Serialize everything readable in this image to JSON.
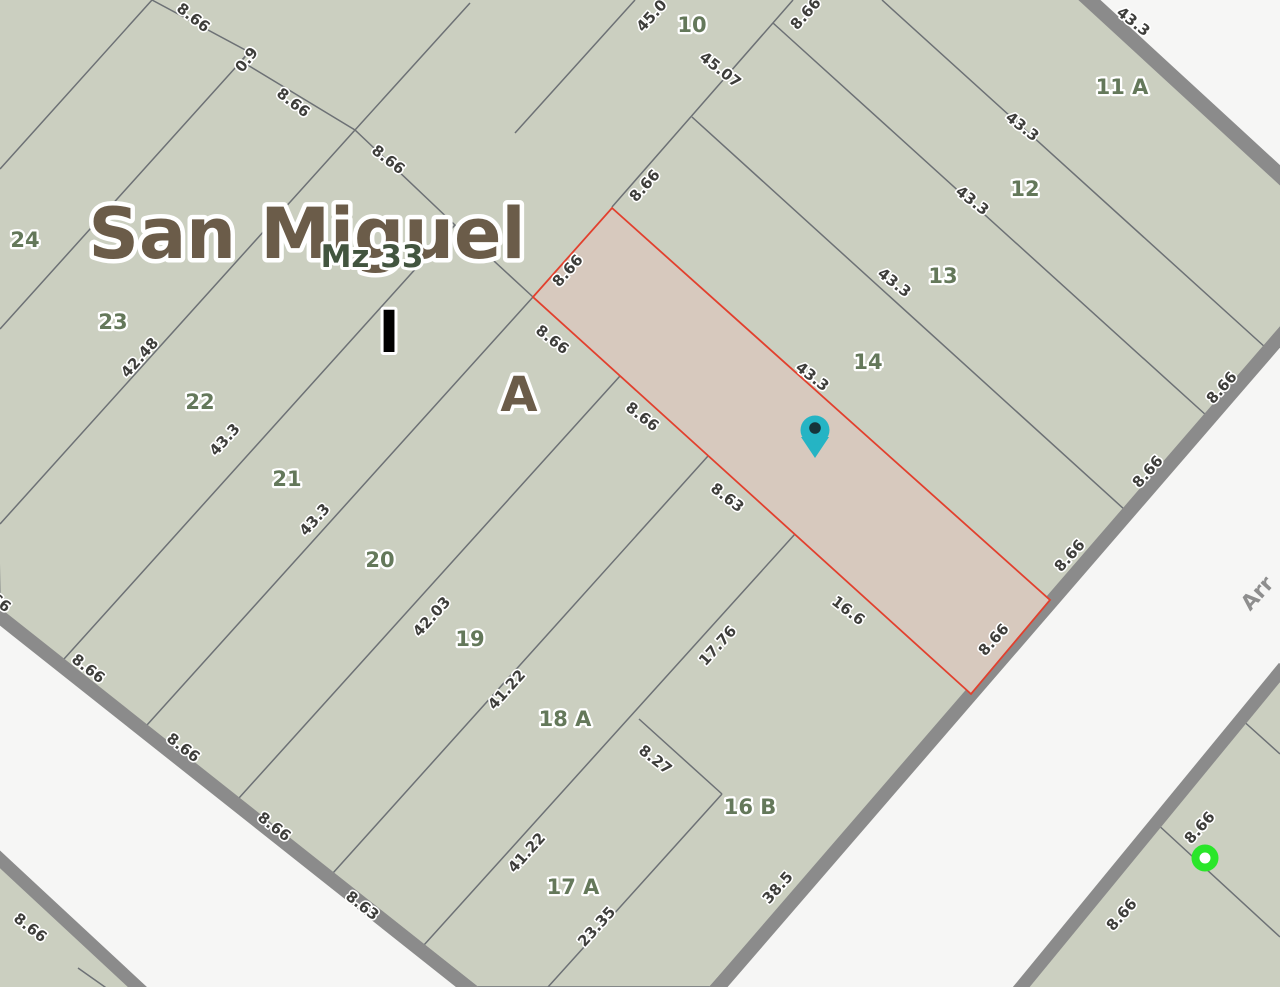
{
  "map": {
    "title": "San Miguel",
    "block_label": "Mz 33",
    "sector_labels": {
      "i": "I",
      "a": "A"
    },
    "street_name": "Arr",
    "colors": {
      "background": "#f6f6f5",
      "parcel_fill": "#cbcfc0",
      "highlight_fill": "#d7c9be",
      "highlight_stroke": "#e2402e",
      "road_casing": "#8b8b8b",
      "lot_line": "#6d7175",
      "parcel_number": "#64785a",
      "dimension_text": "#3d3d3a",
      "title_text": "#6b5c49",
      "block_label_text": "#42553f",
      "pin_fill": "#25b4c4",
      "pin_hole": "#16343a",
      "dot_fill": "#2ae62a"
    },
    "parcel_number_labels": [
      {
        "t": "10",
        "x": 692,
        "y": 26
      },
      {
        "t": "11 A",
        "x": 1122,
        "y": 88
      },
      {
        "t": "12",
        "x": 1025,
        "y": 190
      },
      {
        "t": "13",
        "x": 943,
        "y": 277
      },
      {
        "t": "14",
        "x": 868,
        "y": 363
      },
      {
        "t": "16 B",
        "x": 750,
        "y": 808
      },
      {
        "t": "17 A",
        "x": 573,
        "y": 888
      },
      {
        "t": "18 A",
        "x": 565,
        "y": 720
      },
      {
        "t": "19",
        "x": 470,
        "y": 640
      },
      {
        "t": "20",
        "x": 380,
        "y": 561
      },
      {
        "t": "21",
        "x": 287,
        "y": 480
      },
      {
        "t": "22",
        "x": 200,
        "y": 403
      },
      {
        "t": "23",
        "x": 113,
        "y": 323
      },
      {
        "t": "24",
        "x": 25,
        "y": 241
      }
    ],
    "dimension_labels": [
      {
        "t": "45.0",
        "x": 652,
        "y": 16,
        "r": -48
      },
      {
        "t": "0.9",
        "x": 247,
        "y": 60,
        "r": -52
      },
      {
        "t": "8.66",
        "x": 568,
        "y": 271,
        "r": -48
      },
      {
        "t": "8.66",
        "x": 645,
        "y": 186,
        "r": -48
      },
      {
        "t": "8.66",
        "x": 806,
        "y": 14,
        "r": -48
      },
      {
        "t": "42.48",
        "x": 140,
        "y": 358,
        "r": -48
      },
      {
        "t": "43.3",
        "x": 225,
        "y": 440,
        "r": -48
      },
      {
        "t": "43.3",
        "x": 315,
        "y": 520,
        "r": -48
      },
      {
        "t": "42.03",
        "x": 432,
        "y": 617,
        "r": -48
      },
      {
        "t": "41.22",
        "x": 507,
        "y": 690,
        "r": -48
      },
      {
        "t": "17.76",
        "x": 718,
        "y": 646,
        "r": -48
      },
      {
        "t": "41.22",
        "x": 527,
        "y": 853,
        "r": -48
      },
      {
        "t": "23.35",
        "x": 597,
        "y": 927,
        "r": -48
      },
      {
        "t": "38.5",
        "x": 778,
        "y": 888,
        "r": -48
      },
      {
        "t": "8.66",
        "x": 1222,
        "y": 388,
        "r": -48
      },
      {
        "t": "8.66",
        "x": 1148,
        "y": 472,
        "r": -48
      },
      {
        "t": "8.66",
        "x": 1070,
        "y": 556,
        "r": -48
      },
      {
        "t": "8.66",
        "x": 994,
        "y": 640,
        "r": -48
      },
      {
        "t": "8.66",
        "x": 1200,
        "y": 828,
        "r": -48
      },
      {
        "t": "8.66",
        "x": 1122,
        "y": 915,
        "r": -48
      },
      {
        "t": "8.66",
        "x": 193,
        "y": 18,
        "r": 38
      },
      {
        "t": "8.66",
        "x": 293,
        "y": 103,
        "r": 38
      },
      {
        "t": "8.66",
        "x": 388,
        "y": 160,
        "r": 38
      },
      {
        "t": "8.66",
        "x": 552,
        "y": 340,
        "r": 38
      },
      {
        "t": "8.66",
        "x": 642,
        "y": 417,
        "r": 38
      },
      {
        "t": "8.63",
        "x": 727,
        "y": 498,
        "r": 38
      },
      {
        "t": "16.6",
        "x": 848,
        "y": 611,
        "r": 38
      },
      {
        "t": "43.3",
        "x": 812,
        "y": 377,
        "r": 38
      },
      {
        "t": "43.3",
        "x": 894,
        "y": 283,
        "r": 38
      },
      {
        "t": "43.3",
        "x": 972,
        "y": 201,
        "r": 38
      },
      {
        "t": "43.3",
        "x": 1022,
        "y": 127,
        "r": 38
      },
      {
        "t": "43.3",
        "x": 1133,
        "y": 22,
        "r": 38
      },
      {
        "t": "45.07",
        "x": 720,
        "y": 70,
        "r": 38
      },
      {
        "t": "8.27",
        "x": 655,
        "y": 760,
        "r": 38
      },
      {
        "t": "8.66",
        "x": 88,
        "y": 669,
        "r": 38
      },
      {
        "t": "8.66",
        "x": 183,
        "y": 748,
        "r": 38
      },
      {
        "t": "8.66",
        "x": 274,
        "y": 827,
        "r": 38
      },
      {
        "t": "8.63",
        "x": 362,
        "y": 906,
        "r": 38
      },
      {
        "t": "8.66",
        "x": 30,
        "y": 928,
        "r": 38
      },
      {
        "t": "8.66",
        "x": -6,
        "y": 598,
        "r": 38
      }
    ]
  }
}
